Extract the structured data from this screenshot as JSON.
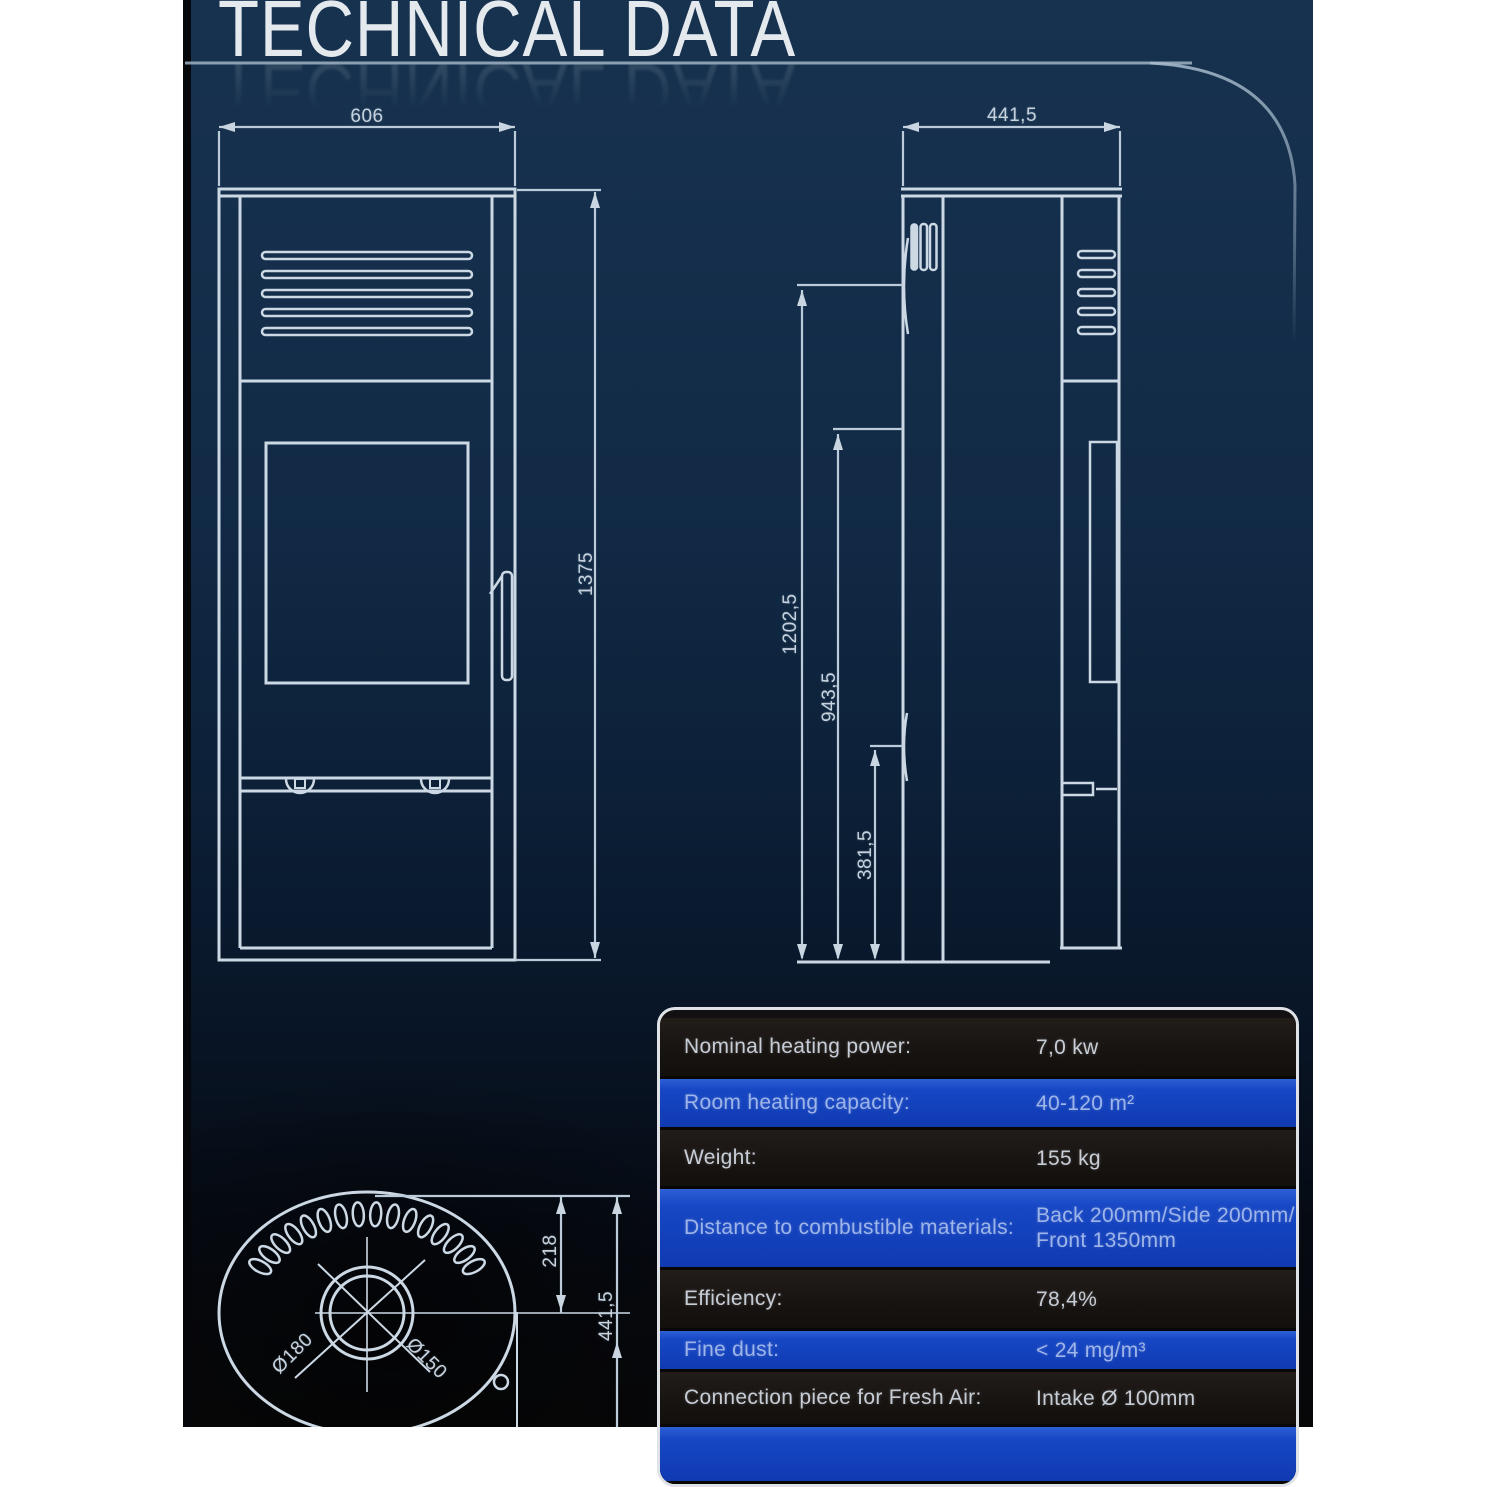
{
  "header": {
    "title": "TECHNICAL DATA"
  },
  "front_view": {
    "dim_width": "606",
    "dim_height": "1375"
  },
  "side_view": {
    "dim_depth": "441,5",
    "dim_total_height": "1202,5",
    "dim_mid_height": "943,5",
    "dim_low_height": "381,5"
  },
  "top_view": {
    "dim_flue_offset": "218",
    "dim_depth": "441,5",
    "flue_outer_diameter": "Ø180",
    "flue_inner_diameter": "Ø150"
  },
  "spec_table": {
    "rows": [
      {
        "label": "Nominal heating power:",
        "value": "7,0 kw"
      },
      {
        "label": "Room heating capacity:",
        "value": "40-120 m²"
      },
      {
        "label": "Weight:",
        "value": "155 kg"
      },
      {
        "label": "Distance to combustible materials:",
        "value": "Back 200mm/Side 200mm/",
        "value2": "Front 1350mm"
      },
      {
        "label": "Efficiency:",
        "value": "78,4%"
      },
      {
        "label": "Fine dust:",
        "value": "< 24 mg/m³"
      },
      {
        "label": "Connection piece for Fresh Air:",
        "value": "Intake Ø 100mm"
      }
    ]
  }
}
